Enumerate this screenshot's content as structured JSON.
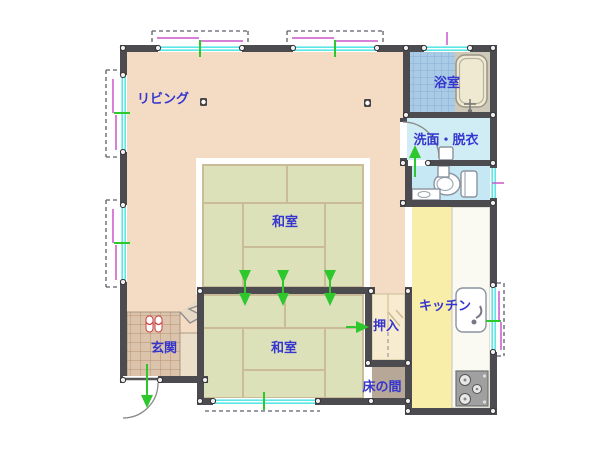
{
  "plan": {
    "rooms": {
      "living": {
        "label": "リビング"
      },
      "bathroom": {
        "label": "浴室"
      },
      "washroom": {
        "label": "洗面・脱衣"
      },
      "kitchen": {
        "label": "キッチン"
      },
      "tatami_upper": {
        "label": "和室"
      },
      "tatami_lower": {
        "label": "和室"
      },
      "closet": {
        "label": "押入"
      },
      "tokonoma": {
        "label": "床の間"
      },
      "entrance": {
        "label": "玄関"
      }
    },
    "fixtures": [
      "bathtub-icon",
      "toilet-icon",
      "washbasin-icon",
      "kitchen-sink-icon",
      "stove-icon",
      "slippers-icon",
      "handwash-counter-icon"
    ],
    "colors": {
      "wall": "#4b4b50",
      "living_floor": "#f4dcc4",
      "tatami": "#dce1ba",
      "tatami_border": "#c9bc96",
      "kitchen_floor": "#f8eda9",
      "counter": "#fbfaf2",
      "bath_tile": "#aacbe6",
      "washroom_floor": "#d0ecf5",
      "toilet_floor": "#c6e8f4",
      "closet_floor": "#f8ecd0",
      "tokonoma_floor": "#b7a796",
      "entrance_tile": "#dcc3ac",
      "window_glass": "#5ce6e6",
      "shutter": "#cc55cc",
      "flow_arrow": "#2ec82e",
      "label_text": "#3535cf"
    }
  }
}
